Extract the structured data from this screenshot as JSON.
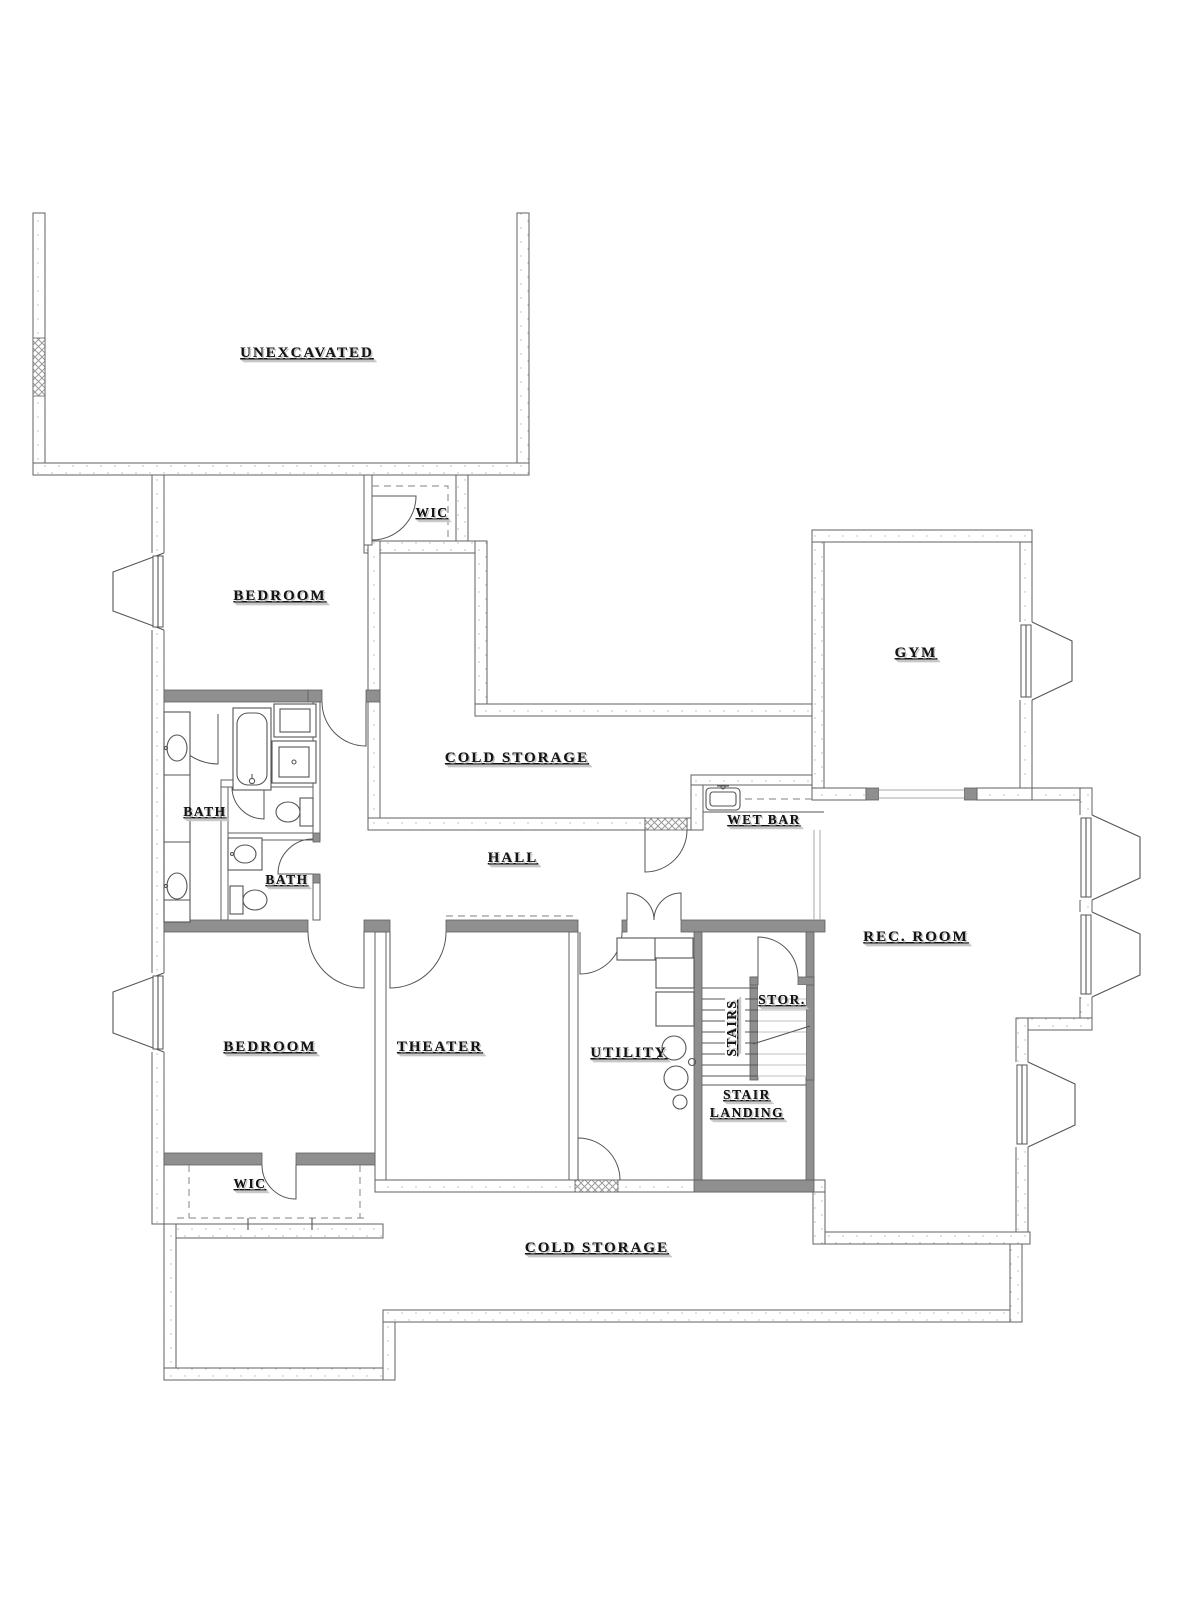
{
  "colors": {
    "line": "#606060",
    "dark": "#8f8f8f",
    "ink": "#141414",
    "shadow": "#c6c6c6",
    "fix": "#555555",
    "dashc": "#9a9a9a",
    "speckle": "#b5b5b5",
    "bg": "#ffffff"
  },
  "rooms": [
    {
      "id": "unexcavated",
      "label": "UNEXCAVATED"
    },
    {
      "id": "wic-top",
      "label": "WIC"
    },
    {
      "id": "bedroom-top",
      "label": "BEDROOM"
    },
    {
      "id": "gym",
      "label": "GYM"
    },
    {
      "id": "cold-storage-top",
      "label": "COLD STORAGE"
    },
    {
      "id": "wet-bar",
      "label": "WET BAR"
    },
    {
      "id": "bath-main",
      "label": "BATH"
    },
    {
      "id": "hall",
      "label": "HALL"
    },
    {
      "id": "bath-small",
      "label": "BATH"
    },
    {
      "id": "rec-room",
      "label": "REC. ROOM"
    },
    {
      "id": "storage",
      "label": "STOR."
    },
    {
      "id": "stairs",
      "label": "STAIRS"
    },
    {
      "id": "bedroom-bottom",
      "label": "BEDROOM"
    },
    {
      "id": "theater",
      "label": "THEATER"
    },
    {
      "id": "utility",
      "label": "UTILITY"
    },
    {
      "id": "stair-landing",
      "label": "STAIR LANDING",
      "lines": [
        "STAIR",
        "LANDING"
      ]
    },
    {
      "id": "wic-bottom",
      "label": "WIC"
    },
    {
      "id": "cold-storage-bottom",
      "label": "COLD STORAGE"
    }
  ]
}
